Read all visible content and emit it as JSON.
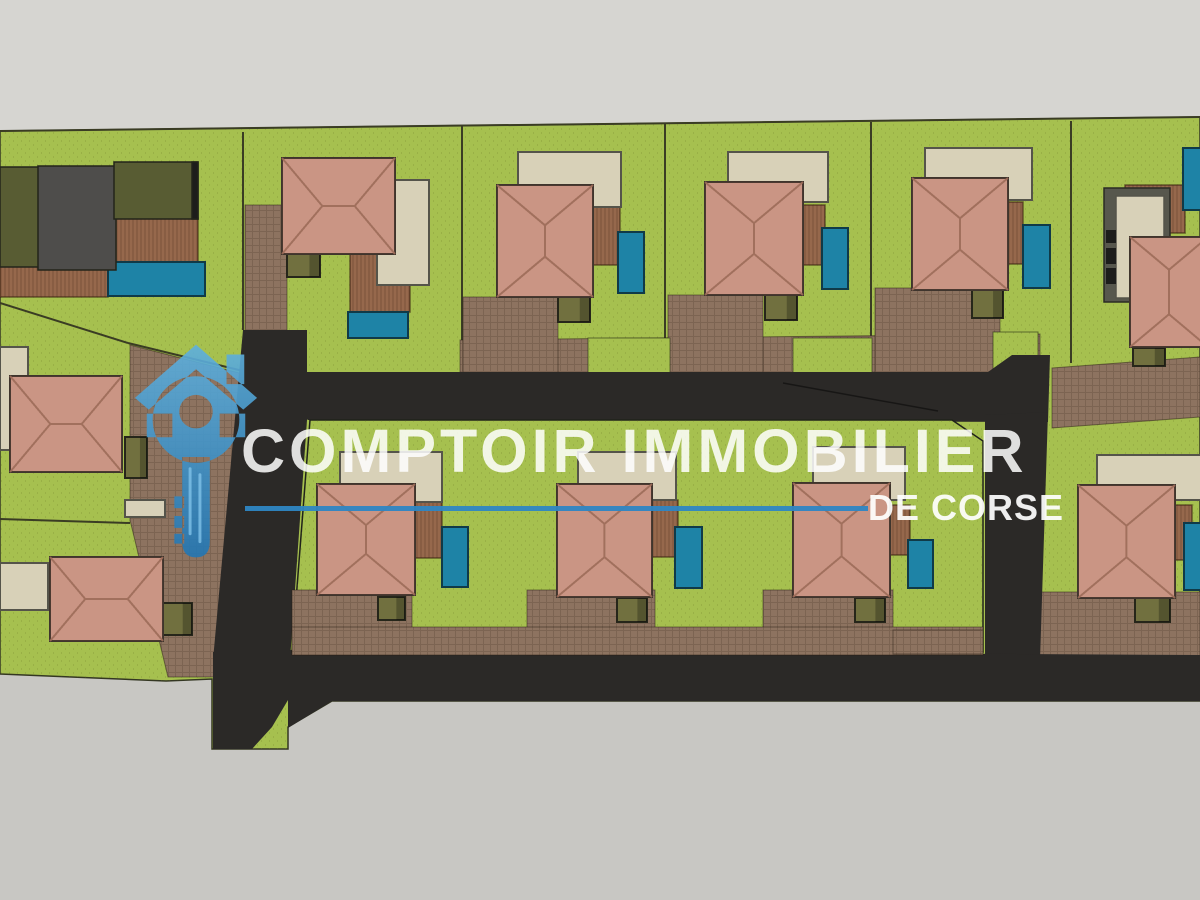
{
  "watermark": {
    "title": "COMPTOIR IMMOBILIER",
    "subtitle": "DE CORSE",
    "logo_icon": "house-key-icon",
    "accent_blue": "#2e86c3"
  },
  "colors": {
    "bg": "#c8c7c3",
    "bgTop": "#d6d5d1",
    "grass": "#a6c04f",
    "grassEdge": "#343722",
    "road": "#2b2927",
    "paver": "#8d7360",
    "deck": "#96684c",
    "roof": "#d2a08f",
    "roofLine": "#9c6b59",
    "roofEdge": "#3f352d",
    "terrace": "#d8d1b8",
    "terraceEdge": "#55544a",
    "pool": "#1e83a6",
    "poolEdge": "#103a48",
    "utility": "#71703f",
    "utilityEdge": "#26261a",
    "modGray": "#4e4d4b",
    "modOlive": "#585c33",
    "wall": "#57574d",
    "window": "#1d1d1b",
    "fence": "#3a3c24",
    "logoBlueLight": "#5fb0dd",
    "logoBlueDark": "#2276b3"
  },
  "scene": {
    "grayTop": [
      [
        0,
        0
      ],
      [
        1200,
        0
      ],
      [
        1200,
        117
      ],
      [
        0,
        131
      ]
    ],
    "terrain": [
      [
        0,
        131
      ],
      [
        1200,
        117
      ],
      [
        1200,
        701
      ],
      [
        332,
        701
      ],
      [
        288,
        727
      ],
      [
        288,
        749
      ],
      [
        212,
        749
      ],
      [
        212,
        679
      ],
      [
        166,
        681
      ],
      [
        0,
        674
      ]
    ],
    "fences": [
      [
        0,
        131,
        1200,
        117
      ],
      [
        243,
        132,
        243,
        330
      ],
      [
        462,
        126,
        462,
        372
      ],
      [
        665,
        124,
        665,
        373
      ],
      [
        871,
        122,
        871,
        370
      ],
      [
        1071,
        121,
        1071,
        363
      ],
      [
        520,
        421,
        520,
        588
      ],
      [
        753,
        421,
        753,
        588
      ],
      [
        0,
        303,
        128,
        343
      ],
      [
        128,
        343,
        243,
        371
      ],
      [
        0,
        519,
        130,
        523
      ]
    ],
    "browns": [
      [
        [
          460,
          340
        ],
        [
          1040,
          334
        ],
        [
          1040,
          378
        ],
        [
          460,
          378
        ]
      ],
      [
        463,
        297,
        95,
        81
      ],
      [
        668,
        295,
        95,
        83
      ],
      [
        [
          875,
          288
        ],
        [
          1000,
          288
        ],
        [
          1000,
          378
        ],
        [
          875,
          378
        ]
      ],
      [
        245,
        205,
        42,
        126
      ],
      [
        [
          130,
          345
        ],
        [
          243,
          374
        ],
        [
          226,
          677
        ],
        [
          168,
          677
        ],
        [
          130,
          520
        ]
      ],
      [
        [
          1052,
          368
        ],
        [
          1200,
          357
        ],
        [
          1200,
          417
        ],
        [
          1052,
          428
        ]
      ],
      [
        1035,
        592,
        165,
        65
      ]
    ],
    "greensOverBrown": [
      [
        588,
        338,
        82,
        40
      ],
      [
        793,
        338,
        79,
        40
      ],
      [
        993,
        332,
        45,
        46
      ]
    ],
    "roads": [
      [
        [
          243,
          372
        ],
        [
          988,
          372
        ],
        [
          1012,
          355
        ],
        [
          1050,
          355
        ],
        [
          1048,
          422
        ],
        [
          308,
          420
        ]
      ],
      [
        [
          243,
          330
        ],
        [
          307,
          330
        ],
        [
          307,
          420
        ],
        [
          290,
          660
        ],
        [
          213,
          660
        ]
      ],
      [
        [
          985,
          415
        ],
        [
          1048,
          412
        ],
        [
          1040,
          660
        ],
        [
          985,
          656
        ]
      ],
      [
        [
          288,
          650
        ],
        [
          1200,
          655
        ],
        [
          1200,
          701
        ],
        [
          332,
          701
        ],
        [
          288,
          728
        ]
      ],
      [
        [
          213,
          652
        ],
        [
          288,
          652
        ],
        [
          288,
          700
        ],
        [
          272,
          727
        ],
        [
          252,
          749
        ],
        [
          213,
          749
        ]
      ]
    ],
    "island": [
      [
        310,
        420
      ],
      [
        952,
        420
      ],
      [
        983,
        441
      ],
      [
        983,
        652
      ],
      [
        292,
        652
      ]
    ],
    "islandDrives": [
      [
        292,
        590,
        120,
        65
      ],
      [
        527,
        590,
        128,
        65
      ],
      [
        763,
        590,
        130,
        65
      ],
      [
        292,
        627,
        691,
        28
      ],
      [
        893,
        630,
        90,
        24
      ]
    ],
    "decks": [
      [
        593,
        205,
        27,
        60
      ],
      [
        800,
        205,
        25,
        60
      ],
      [
        1006,
        202,
        17,
        62
      ],
      [
        413,
        500,
        29,
        58
      ],
      [
        650,
        500,
        28,
        57
      ],
      [
        883,
        505,
        27,
        50
      ],
      [
        1125,
        185,
        60,
        48
      ],
      [
        1175,
        505,
        17,
        55
      ],
      [
        350,
        253,
        60,
        59
      ],
      [
        114,
        218,
        84,
        46
      ],
      [
        0,
        265,
        108,
        32
      ]
    ],
    "terraces": [
      [
        377,
        180,
        52,
        105
      ],
      [
        518,
        152,
        103,
        55
      ],
      [
        728,
        152,
        100,
        50
      ],
      [
        925,
        148,
        107,
        52
      ],
      [
        1097,
        455,
        105,
        45
      ],
      [
        340,
        452,
        102,
        50
      ],
      [
        578,
        452,
        98,
        48
      ],
      [
        813,
        447,
        92,
        53
      ],
      [
        0,
        347,
        28,
        103
      ],
      [
        0,
        563,
        48,
        47
      ],
      [
        125,
        500,
        40,
        17
      ]
    ],
    "pools": [
      [
        108,
        262,
        97,
        34
      ],
      [
        348,
        312,
        60,
        26
      ],
      [
        618,
        232,
        26,
        61
      ],
      [
        822,
        228,
        26,
        61
      ],
      [
        1023,
        225,
        27,
        63
      ],
      [
        1183,
        148,
        25,
        62
      ],
      [
        1184,
        523,
        24,
        67
      ],
      [
        442,
        527,
        26,
        60
      ],
      [
        675,
        527,
        27,
        61
      ],
      [
        908,
        540,
        25,
        48
      ]
    ],
    "utilities": [
      [
        287,
        253,
        33,
        24
      ],
      [
        558,
        297,
        32,
        25
      ],
      [
        765,
        295,
        32,
        25
      ],
      [
        972,
        290,
        31,
        28
      ],
      [
        1133,
        348,
        32,
        18
      ],
      [
        1135,
        598,
        35,
        24
      ],
      [
        378,
        597,
        27,
        23
      ],
      [
        617,
        598,
        30,
        24
      ],
      [
        855,
        598,
        30,
        24
      ],
      [
        125,
        437,
        22,
        41
      ],
      [
        163,
        603,
        29,
        32
      ]
    ],
    "houses": [
      [
        282,
        158,
        113,
        96
      ],
      [
        497,
        185,
        96,
        112
      ],
      [
        705,
        182,
        98,
        113
      ],
      [
        912,
        178,
        96,
        112
      ],
      [
        1130,
        237,
        78,
        110
      ],
      [
        10,
        376,
        112,
        96
      ],
      [
        50,
        557,
        113,
        84
      ],
      [
        317,
        484,
        98,
        111
      ],
      [
        557,
        484,
        95,
        113
      ],
      [
        793,
        483,
        97,
        114
      ],
      [
        1078,
        485,
        97,
        113
      ]
    ],
    "modernHouse": [
      {
        "r": [
          0,
          167,
          40,
          100
        ],
        "c": "modOlive"
      },
      {
        "r": [
          38,
          166,
          78,
          104
        ],
        "c": "modGray"
      },
      {
        "r": [
          114,
          162,
          84,
          57
        ],
        "c": "modOlive"
      },
      {
        "r": [
          192,
          162,
          6,
          57
        ],
        "c": "window"
      }
    ],
    "wallHouse": {
      "frame": [
        1104,
        188,
        66,
        114
      ],
      "inner": [
        1116,
        196,
        48,
        102
      ],
      "windows": [
        [
          1106,
          230,
          10,
          13
        ],
        [
          1106,
          248,
          10,
          16
        ],
        [
          1106,
          268,
          10,
          16
        ]
      ]
    },
    "roadLine": [
      783,
      383,
      938,
      411
    ]
  }
}
